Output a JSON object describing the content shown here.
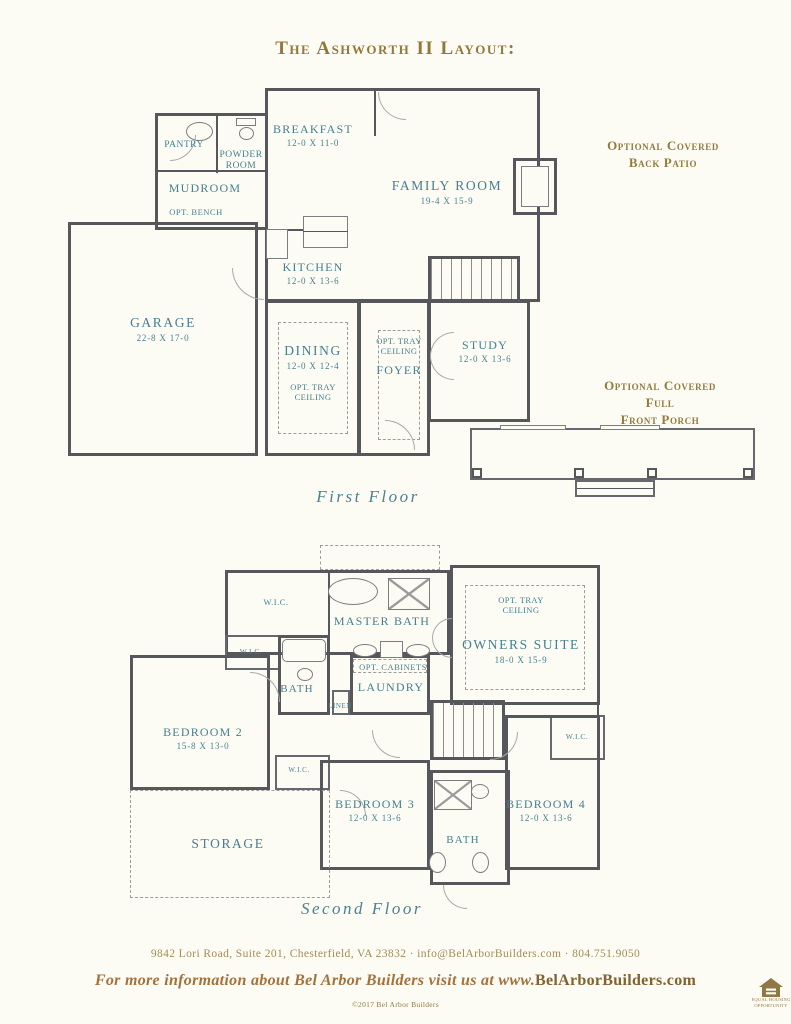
{
  "page": {
    "title": "The Ashworth II Layout:",
    "background": "#fdfcf4",
    "accent_gold": "#957839",
    "accent_teal": "#44808f",
    "wall_gray": "#55575b"
  },
  "floor1": {
    "caption": "First Floor",
    "annotations": {
      "back_patio_1": "Optional Covered",
      "back_patio_2": "Back Patio",
      "front_porch_1": "Optional Covered Full",
      "front_porch_2": "Front Porch"
    },
    "rooms": {
      "pantry": {
        "name": "PANTRY"
      },
      "powder": {
        "name": "POWDER ROOM"
      },
      "breakfast": {
        "name": "BREAKFAST",
        "dims": "12-0 X 11-0"
      },
      "mudroom": {
        "name": "MUDROOM"
      },
      "opt_bench": {
        "name": "OPT. BENCH"
      },
      "family": {
        "name": "FAMILY ROOM",
        "dims": "19-4 X 15-9"
      },
      "kitchen": {
        "name": "KITCHEN",
        "dims": "12-0 X 13-6"
      },
      "garage": {
        "name": "GARAGE",
        "dims": "22-8 X 17-0"
      },
      "dining": {
        "name": "DINING",
        "dims": "12-0 X 12-4",
        "note": "OPT. TRAY CEILING"
      },
      "foyer": {
        "name": "FOYER",
        "note": "OPT. TRAY CEILING"
      },
      "study": {
        "name": "STUDY",
        "dims": "12-0 X 13-6"
      }
    }
  },
  "floor2": {
    "caption": "Second Floor",
    "rooms": {
      "wic_top": {
        "name": "W.I.C."
      },
      "master_bath": {
        "name": "MASTER BATH"
      },
      "owners": {
        "name": "OWNERS SUITE",
        "dims": "18-0 X 15-9",
        "note": "OPT. TRAY CEILING"
      },
      "wic_left": {
        "name": "W.I.C."
      },
      "bath_up": {
        "name": "BATH"
      },
      "opt_cabinets": {
        "name": "OPT. CABINETS"
      },
      "laundry": {
        "name": "LAUNDRY"
      },
      "linen": {
        "name": "LINEN"
      },
      "bedroom2": {
        "name": "BEDROOM 2",
        "dims": "15-8 X 13-0"
      },
      "wic_right": {
        "name": "W.I.C."
      },
      "wic_small": {
        "name": "W.I.C."
      },
      "bedroom3": {
        "name": "BEDROOM 3",
        "dims": "12-0 X 13-6"
      },
      "bath_low": {
        "name": "BATH"
      },
      "bedroom4": {
        "name": "BEDROOM 4",
        "dims": "12-0 X 13-6"
      },
      "storage": {
        "name": "STORAGE"
      }
    }
  },
  "footer": {
    "address": "9842 Lori Road, Suite 201, Chesterfield, VA 23832   ·   info@BelArborBuilders.com   ·   804.751.9050",
    "cta_italic": "For more information about Bel Arbor Builders visit us at www.",
    "cta_domain": "BelArborBuilders.com",
    "copyright": "©2017 Bel Arbor Builders",
    "equal_housing_1": "EQUAL HOUSING",
    "equal_housing_2": "OPPORTUNITY"
  }
}
